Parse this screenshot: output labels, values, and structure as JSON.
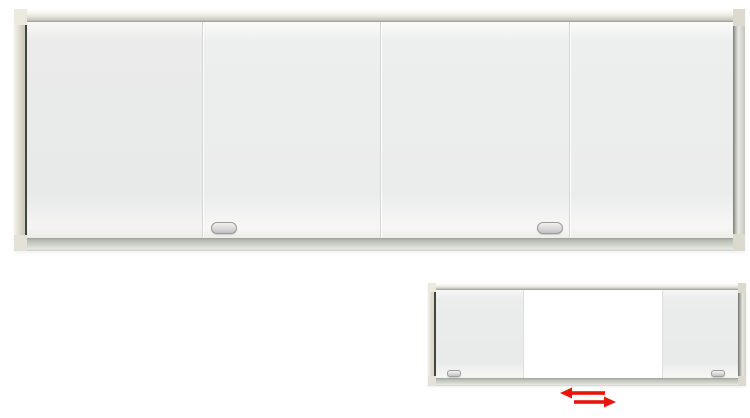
{
  "page": {
    "background": "#ffffff"
  },
  "product": {
    "type": "sliding-panel-whiteboard",
    "main_view": {
      "name": "sliding-whiteboard-front-closed",
      "panel_count": 4,
      "handle_count": 2,
      "state": "panels-closed"
    },
    "inset_view": {
      "name": "sliding-whiteboard-panels-open",
      "panel_count": 2,
      "handle_count": 2,
      "state": "panels-slid-open-center-exposed"
    },
    "icons": {
      "slide_arrows": "left-right-slide-arrows-icon"
    }
  },
  "colors": {
    "page-bg": "#ffffff",
    "accent-red": "#e8140e",
    "frame-beige": "#ddd9cc",
    "frame-highlight": "#f7f6f1",
    "frame-shadow-line": "#42463f",
    "rail-metal": "#c7c8c1",
    "tray-gray": "#ccd0c7",
    "panel-gray": "#ebecec",
    "panel-white": "#ffffff",
    "divider-gray": "#d5d6d5",
    "handle-border": "#9b9b9b",
    "handle-fill": "#d9d9d9"
  }
}
